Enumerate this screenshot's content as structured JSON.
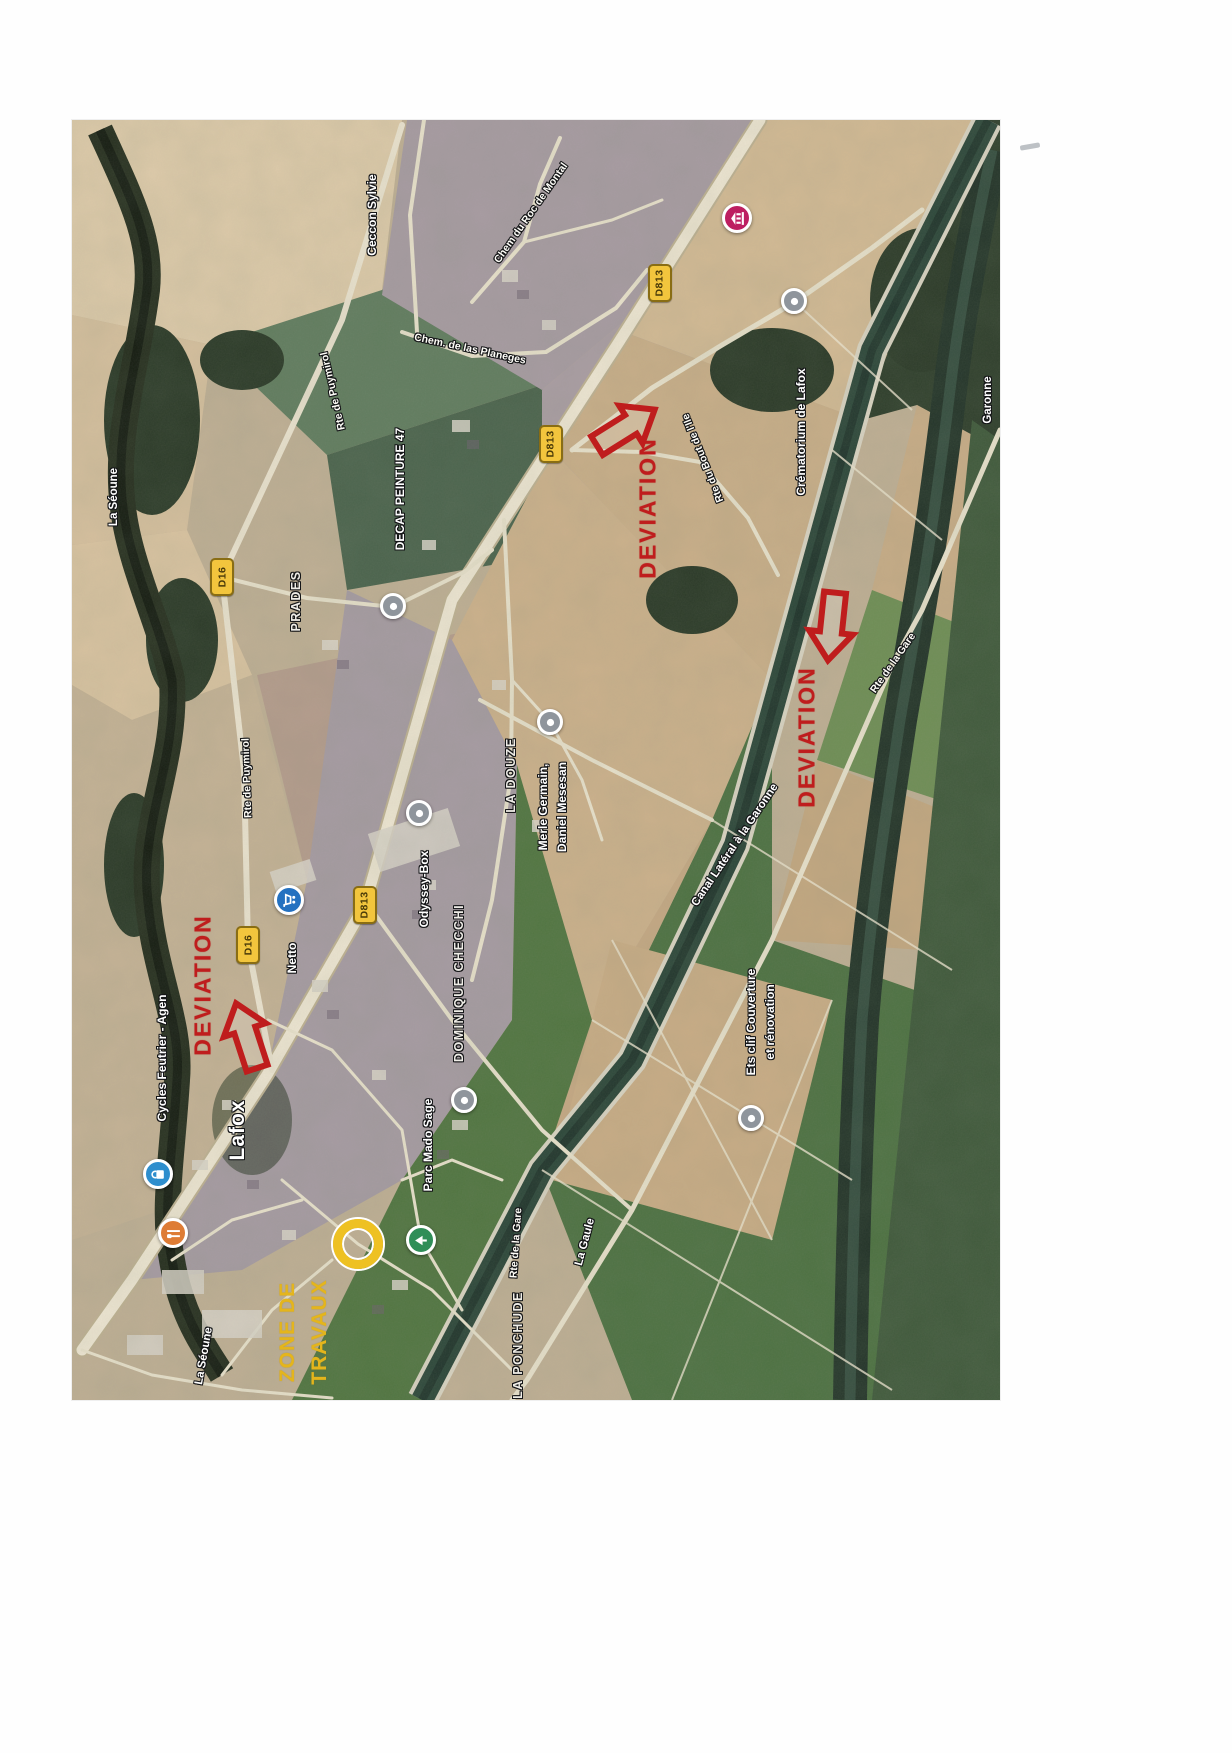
{
  "map": {
    "x": 72,
    "y": 120,
    "width": 928,
    "height": 1280
  },
  "labels": [
    {
      "name": "ceccon-sylvie",
      "text": "Ceccon Sylvie",
      "x": 372,
      "y": 215,
      "rot": -90,
      "kind": "business"
    },
    {
      "name": "chem-du-roc-de-montal",
      "text": "Chem du Roc de Montal",
      "x": 531,
      "y": 213,
      "rot": -55,
      "kind": "road"
    },
    {
      "name": "chem-de-las-planeges",
      "text": "Chem. de las Planeges",
      "x": 470,
      "y": 349,
      "rot": 12,
      "kind": "road"
    },
    {
      "name": "rte-de-puymirol-nord",
      "text": "Rte de Puymirol",
      "x": 333,
      "y": 391,
      "rot": -103,
      "kind": "road"
    },
    {
      "name": "rte-de-puymirol-sud",
      "text": "Rte de Puymirol",
      "x": 247,
      "y": 778,
      "rot": -92,
      "kind": "road"
    },
    {
      "name": "la-seoune-nord",
      "text": "La Séoune",
      "x": 114,
      "y": 497,
      "rot": -90,
      "kind": "water"
    },
    {
      "name": "prades",
      "text": "PRADES",
      "x": 296,
      "y": 601,
      "rot": -90,
      "kind": "hamlet"
    },
    {
      "name": "decap-peinture-47",
      "text": "DECAP PEINTURE 47",
      "x": 400,
      "y": 489,
      "rot": -90,
      "kind": "business"
    },
    {
      "name": "la-douze",
      "text": "LA DOUZE",
      "x": 511,
      "y": 775,
      "rot": -90,
      "kind": "hamlet"
    },
    {
      "name": "merle-germain",
      "text": "Merle Germain,",
      "x": 543,
      "y": 807,
      "rot": -90,
      "kind": "business"
    },
    {
      "name": "daniel-mesesan",
      "text": "Daniel Mesesan",
      "x": 562,
      "y": 807,
      "rot": -90,
      "kind": "business"
    },
    {
      "name": "odyssey-box",
      "text": "Odyssey-Box",
      "x": 424,
      "y": 889,
      "rot": -90,
      "kind": "business"
    },
    {
      "name": "netto",
      "text": "Netto",
      "x": 292,
      "y": 958,
      "rot": -90,
      "kind": "business"
    },
    {
      "name": "dominique-checchi",
      "text": "DOMINIQUE CHECCHI",
      "x": 459,
      "y": 983,
      "rot": -90,
      "kind": "hamlet"
    },
    {
      "name": "lafox",
      "text": "Lafox",
      "x": 238,
      "y": 1130,
      "rot": -90,
      "kind": "town"
    },
    {
      "name": "cycles-feutrier-agen",
      "text": "Cycles Feutrier - Agen",
      "x": 162,
      "y": 1058,
      "rot": -90,
      "kind": "business"
    },
    {
      "name": "parc-mado-sage",
      "text": "Parc Mado Sage",
      "x": 428,
      "y": 1145,
      "rot": -90,
      "kind": "business"
    },
    {
      "name": "la-seoune-sud",
      "text": "La Séoune",
      "x": 204,
      "y": 1356,
      "rot": -80,
      "kind": "water"
    },
    {
      "name": "la-ponchude",
      "text": "LA PONCHUDE",
      "x": 518,
      "y": 1345,
      "rot": -90,
      "kind": "hamlet"
    },
    {
      "name": "la-gaule",
      "text": "La Gaule",
      "x": 585,
      "y": 1242,
      "rot": -75,
      "kind": "water"
    },
    {
      "name": "rte-de-la-gare-sud",
      "text": "Rte de la Gare",
      "x": 516,
      "y": 1243,
      "rot": -86,
      "kind": "road"
    },
    {
      "name": "canal-lateral-a-la-garonne",
      "text": "Canal Latéral à la Garonne",
      "x": 735,
      "y": 845,
      "rot": -56,
      "kind": "water"
    },
    {
      "name": "rte-de-la-gare-nord",
      "text": "Rte de la Gare",
      "x": 893,
      "y": 663,
      "rot": -55,
      "kind": "road"
    },
    {
      "name": "rte-du-bout-de-l-ile",
      "text": "Rte du Bout de l'Ile",
      "x": 703,
      "y": 458,
      "rot": -112,
      "kind": "road"
    },
    {
      "name": "crematorium-de-lafox",
      "text": "Crématorium de Lafox",
      "x": 801,
      "y": 432,
      "rot": -90,
      "kind": "business"
    },
    {
      "name": "garonne",
      "text": "Garonne",
      "x": 988,
      "y": 400,
      "rot": -90,
      "kind": "water"
    },
    {
      "name": "ets-clif-couverture",
      "text": "Ets clif Couverture",
      "x": 751,
      "y": 1022,
      "rot": -90,
      "kind": "business"
    },
    {
      "name": "et-renovation",
      "text": "et rénovation",
      "x": 770,
      "y": 1022,
      "rot": -90,
      "kind": "business"
    }
  ],
  "road_badges": [
    {
      "name": "d813-badge-1",
      "text": "D813",
      "x": 660,
      "y": 283
    },
    {
      "name": "d813-badge-2",
      "text": "D813",
      "x": 551,
      "y": 444
    },
    {
      "name": "d813-badge-3",
      "text": "D813",
      "x": 365,
      "y": 905
    },
    {
      "name": "d16-badge-1",
      "text": "D16",
      "x": 222,
      "y": 577
    },
    {
      "name": "d16-badge-2",
      "text": "D16",
      "x": 248,
      "y": 945
    }
  ],
  "pois": [
    {
      "name": "museum-poi",
      "x": 737,
      "y": 218,
      "color": "#c21f63",
      "glyph": "museum"
    },
    {
      "name": "crematorium-poi",
      "x": 794,
      "y": 301,
      "color": "#8e959c",
      "glyph": "dot"
    },
    {
      "name": "decap-peinture-poi",
      "x": 393,
      "y": 606,
      "color": "#8e959c",
      "glyph": "dot"
    },
    {
      "name": "merle-germain-poi",
      "x": 550,
      "y": 722,
      "color": "#8e959c",
      "glyph": "dot"
    },
    {
      "name": "odyssey-box-poi",
      "x": 419,
      "y": 813,
      "color": "#8e959c",
      "glyph": "dot"
    },
    {
      "name": "netto-poi",
      "x": 289,
      "y": 900,
      "color": "#2272c3",
      "glyph": "cart"
    },
    {
      "name": "dominique-checchi-poi",
      "x": 464,
      "y": 1100,
      "color": "#8e959c",
      "glyph": "dot"
    },
    {
      "name": "cycles-feutrier-poi",
      "x": 158,
      "y": 1174,
      "color": "#2b8fd0",
      "glyph": "shop"
    },
    {
      "name": "restaurant-poi",
      "x": 173,
      "y": 1233,
      "color": "#e07b32",
      "glyph": "restaurant"
    },
    {
      "name": "parc-mado-sage-poi",
      "x": 421,
      "y": 1240,
      "color": "#2d8f57",
      "glyph": "tree"
    },
    {
      "name": "ets-clif-poi",
      "x": 751,
      "y": 1118,
      "color": "#8e959c",
      "glyph": "dot"
    }
  ],
  "deviation": {
    "color": "#c41d1d",
    "texts": [
      {
        "name": "deviation-text-west",
        "text": "DEVIATION",
        "x": 203,
        "y": 985,
        "rot": -90
      },
      {
        "name": "deviation-text-center",
        "text": "DEVIATION",
        "x": 648,
        "y": 508,
        "rot": -90
      },
      {
        "name": "deviation-text-east",
        "text": "DEVIATION",
        "x": 807,
        "y": 737,
        "rot": -90
      }
    ],
    "arrows": [
      {
        "name": "deviation-arrow-west",
        "x": 248,
        "y": 1040,
        "rot": -18
      },
      {
        "name": "deviation-arrow-center",
        "x": 622,
        "y": 430,
        "rot": 58
      },
      {
        "name": "deviation-arrow-east",
        "x": 832,
        "y": 622,
        "rot": 186
      }
    ]
  },
  "work_zone": {
    "color": "#e4b416",
    "lines": [
      {
        "name": "zone-de-travaux-line1",
        "text": "ZONE DE",
        "x": 288,
        "y": 1332,
        "rot": -90
      },
      {
        "name": "zone-de-travaux-line2",
        "text": "TRAVAUX",
        "x": 320,
        "y": 1332,
        "rot": -90
      }
    ],
    "ring": {
      "x": 358,
      "y": 1244
    }
  },
  "scan_mark": {
    "x": 1020,
    "y": 144
  }
}
